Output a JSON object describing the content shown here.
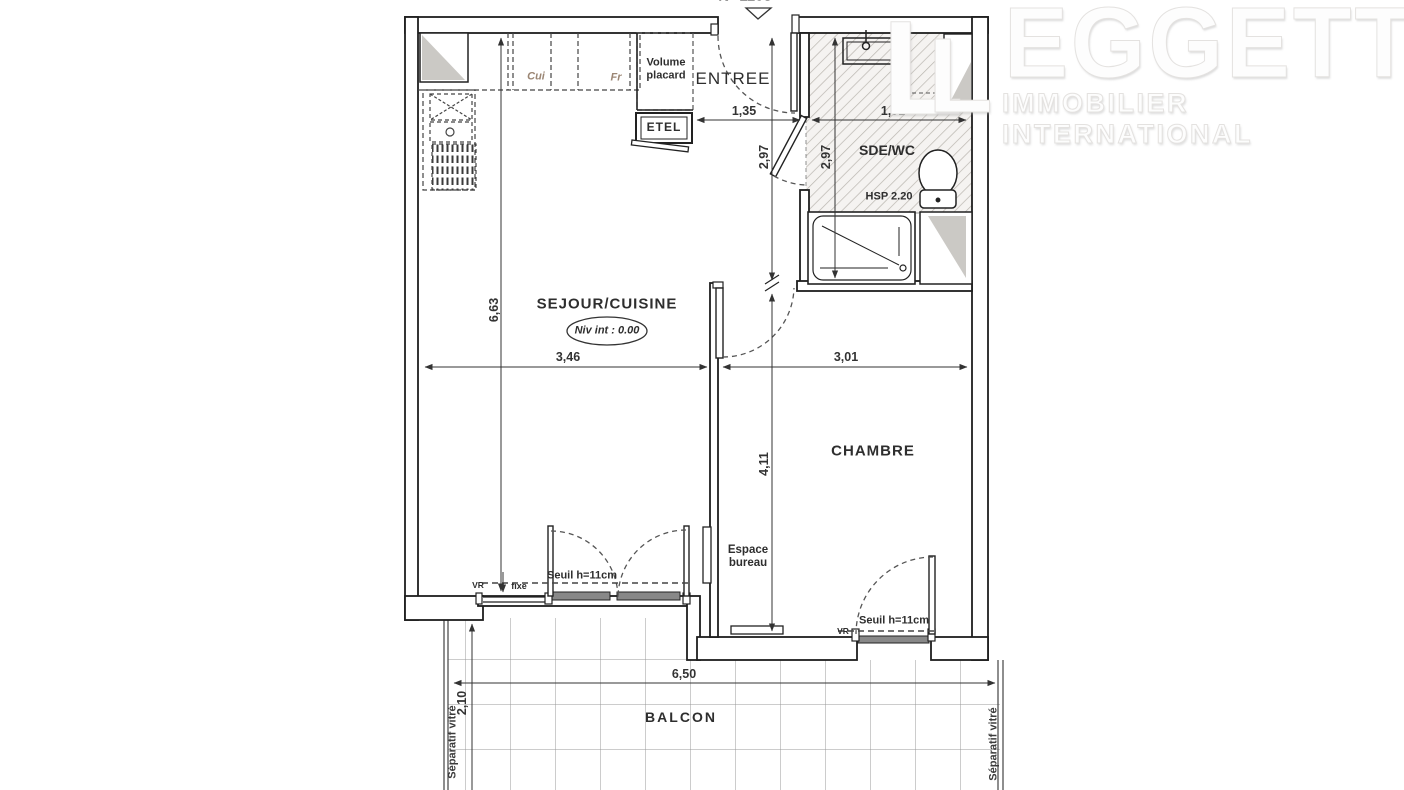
{
  "plan": {
    "number": "N° 1103",
    "rooms": {
      "entree": "ENTREE",
      "sde_wc": "SDE/WC",
      "sejour": "SEJOUR/CUISINE",
      "chambre": "CHAMBRE",
      "balcon": "BALCON"
    },
    "labels": {
      "volume_placard": "Volume placard",
      "etel": "ETEL",
      "cui": "Cui",
      "fr": "Fr",
      "niv": "Niv int : 0.00",
      "hsp": "HSP 2.20",
      "espace_bureau": "Espace bureau",
      "seuil_sejour": "Seuil h=11cm",
      "seuil_chambre": "Seuil h=11cm",
      "vr_sejour": "VR",
      "vr_chambre": "VR",
      "fixe": "fixe",
      "separatif_left": "Séparatif vitré",
      "separatif_right": "Séparatif vitré"
    },
    "dimensions": {
      "entree_width": "1,35",
      "sde_width": "1,91",
      "entree_depth": "2,97",
      "sde_depth": "2,97",
      "sejour_depth": "6,63",
      "sejour_width": "3,46",
      "chambre_width": "3,01",
      "chambre_depth": "4,11",
      "balcon_width": "6,50",
      "balcon_depth": "2,10"
    }
  },
  "logo": {
    "monogram": "L",
    "wordmark": "EGGETT",
    "subtitle": "IMMOBILIER  INTERNATIONAL"
  },
  "colors": {
    "wall_line": "#1e1e1e",
    "dim_line": "#333333",
    "hatch": "#b9b5af",
    "tile_grid": "#999999",
    "kitchen_label": "#9b8674",
    "duct_fill": "#cbc9c5",
    "logo_text": "#fdfdfd"
  }
}
